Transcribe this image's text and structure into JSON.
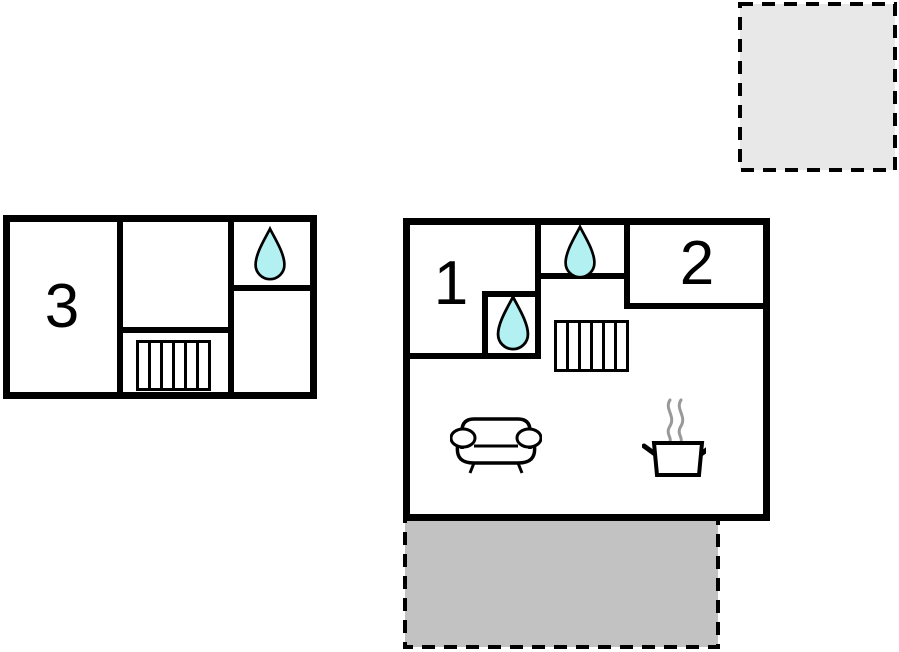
{
  "page": {
    "background": "#ffffff"
  },
  "colors": {
    "wall": "#000000",
    "water_fill": "#b2f0f2",
    "terrace_top_fill": "#e8e8e8",
    "terrace_bottom_fill": "#c2c2c2",
    "steam": "#999999"
  },
  "floorplan_left": {
    "room3_label": "3"
  },
  "floorplan_main": {
    "room1_label": "1",
    "room2_label": "2"
  },
  "icons": {
    "water_drop": "water-drop-icon",
    "radiator": "radiator-icon",
    "sofa": "sofa-icon",
    "cooking_pot": "cooking-pot-icon"
  }
}
